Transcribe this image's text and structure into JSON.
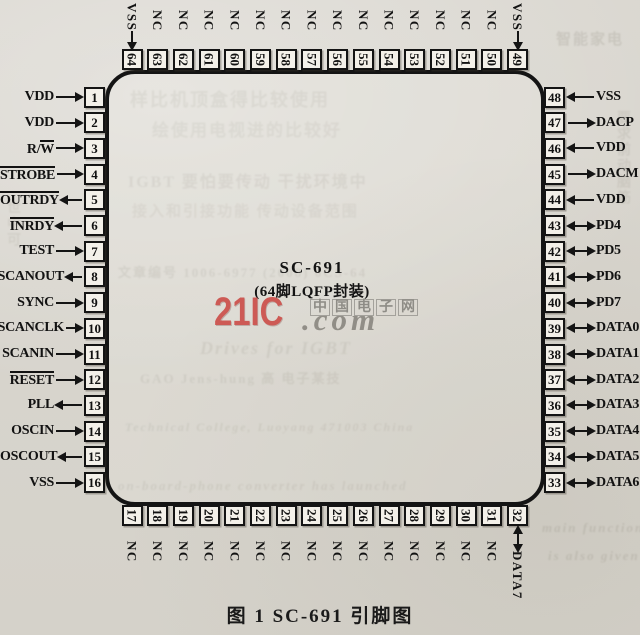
{
  "figure": {
    "chip_name": "SC-691",
    "package": "(64脚LQFP封装)",
    "caption": "图 1  SC-691 引脚图"
  },
  "watermark": {
    "brand": "21IC",
    "cn": "中国电子网",
    "com": ".com",
    "brand_color": "#cd5a55",
    "gray_color": "#8e8c86"
  },
  "colors": {
    "paper": "#d8d5cd",
    "ink": "#141414",
    "pin_box_fill": "#f3f0e9"
  },
  "pins": {
    "left": [
      {
        "num": 1,
        "label": "VDD",
        "dir": "in"
      },
      {
        "num": 2,
        "label": "VDD",
        "dir": "in"
      },
      {
        "num": 3,
        "segments": [
          {
            "t": "R/",
            "ol": false
          },
          {
            "t": "W",
            "ol": true
          }
        ],
        "dir": "in"
      },
      {
        "num": 4,
        "label": "STROBE",
        "ol": true,
        "dir": "in"
      },
      {
        "num": 5,
        "label": "OUTRDY",
        "ol": true,
        "dir": "out"
      },
      {
        "num": 6,
        "label": "INRDY",
        "ol": true,
        "dir": "out"
      },
      {
        "num": 7,
        "label": "TEST",
        "dir": "in"
      },
      {
        "num": 8,
        "label": "SCANOUT",
        "dir": "out"
      },
      {
        "num": 9,
        "label": "SYNC",
        "dir": "in"
      },
      {
        "num": 10,
        "label": "SCANCLK",
        "dir": "in"
      },
      {
        "num": 11,
        "label": "SCANIN",
        "dir": "in"
      },
      {
        "num": 12,
        "label": "RESET",
        "ol": true,
        "dir": "in"
      },
      {
        "num": 13,
        "label": "PLL",
        "dir": "out"
      },
      {
        "num": 14,
        "label": "OSCIN",
        "dir": "in"
      },
      {
        "num": 15,
        "label": "OSCOUT",
        "dir": "out"
      },
      {
        "num": 16,
        "label": "VSS",
        "dir": "in"
      }
    ],
    "right": [
      {
        "num": 48,
        "label": "VSS",
        "dir": "in"
      },
      {
        "num": 47,
        "label": "DACP",
        "dir": "out"
      },
      {
        "num": 46,
        "label": "VDD",
        "dir": "in"
      },
      {
        "num": 45,
        "label": "DACM",
        "dir": "out"
      },
      {
        "num": 44,
        "label": "VDD",
        "dir": "in"
      },
      {
        "num": 43,
        "label": "PD4",
        "dir": "bidir"
      },
      {
        "num": 42,
        "label": "PD5",
        "dir": "bidir"
      },
      {
        "num": 41,
        "label": "PD6",
        "dir": "bidir"
      },
      {
        "num": 40,
        "label": "PD7",
        "dir": "bidir"
      },
      {
        "num": 39,
        "label": "DATA0",
        "dir": "bidir"
      },
      {
        "num": 38,
        "label": "DATA1",
        "dir": "bidir"
      },
      {
        "num": 37,
        "label": "DATA2",
        "dir": "bidir"
      },
      {
        "num": 36,
        "label": "DATA3",
        "dir": "bidir"
      },
      {
        "num": 35,
        "label": "DATA4",
        "dir": "bidir"
      },
      {
        "num": 34,
        "label": "DATA5",
        "dir": "bidir"
      },
      {
        "num": 33,
        "label": "DATA6",
        "dir": "bidir"
      }
    ],
    "top": [
      {
        "num": 64,
        "label": "VSS",
        "dir": "in"
      },
      {
        "num": 63,
        "label": "NC",
        "dir": "none"
      },
      {
        "num": 62,
        "label": "NC",
        "dir": "none"
      },
      {
        "num": 61,
        "label": "NC",
        "dir": "none"
      },
      {
        "num": 60,
        "label": "NC",
        "dir": "none"
      },
      {
        "num": 59,
        "label": "NC",
        "dir": "none"
      },
      {
        "num": 58,
        "label": "NC",
        "dir": "none"
      },
      {
        "num": 57,
        "label": "NC",
        "dir": "none"
      },
      {
        "num": 56,
        "label": "NC",
        "dir": "none"
      },
      {
        "num": 55,
        "label": "NC",
        "dir": "none"
      },
      {
        "num": 54,
        "label": "NC",
        "dir": "none"
      },
      {
        "num": 53,
        "label": "NC",
        "dir": "none"
      },
      {
        "num": 52,
        "label": "NC",
        "dir": "none"
      },
      {
        "num": 51,
        "label": "NC",
        "dir": "none"
      },
      {
        "num": 50,
        "label": "NC",
        "dir": "none"
      },
      {
        "num": 49,
        "label": "VSS",
        "dir": "in"
      }
    ],
    "bottom": [
      {
        "num": 17,
        "label": "NC",
        "dir": "none"
      },
      {
        "num": 18,
        "label": "NC",
        "dir": "none"
      },
      {
        "num": 19,
        "label": "NC",
        "dir": "none"
      },
      {
        "num": 20,
        "label": "NC",
        "dir": "none"
      },
      {
        "num": 21,
        "label": "NC",
        "dir": "none"
      },
      {
        "num": 22,
        "label": "NC",
        "dir": "none"
      },
      {
        "num": 23,
        "label": "NC",
        "dir": "none"
      },
      {
        "num": 24,
        "label": "NC",
        "dir": "none"
      },
      {
        "num": 25,
        "label": "NC",
        "dir": "none"
      },
      {
        "num": 26,
        "label": "NC",
        "dir": "none"
      },
      {
        "num": 27,
        "label": "NC",
        "dir": "none"
      },
      {
        "num": 28,
        "label": "NC",
        "dir": "none"
      },
      {
        "num": 29,
        "label": "NC",
        "dir": "none"
      },
      {
        "num": 30,
        "label": "NC",
        "dir": "none"
      },
      {
        "num": 31,
        "label": "NC",
        "dir": "none"
      },
      {
        "num": 32,
        "label": "DATA7",
        "dir": "bidir"
      }
    ]
  },
  "bleedthrough": [
    {
      "t": "样比机顶盒得比较使用",
      "x": 130,
      "y": 86,
      "s": 18,
      "o": 0.11
    },
    {
      "t": "绘使用电视进的比较好",
      "x": 152,
      "y": 116,
      "s": 17,
      "o": 0.1
    },
    {
      "t": "IGBT 要怕要传动 干扰环境中",
      "x": 128,
      "y": 168,
      "s": 16,
      "o": 0.12
    },
    {
      "t": "接入和引接功能 传动设备范围",
      "x": 132,
      "y": 200,
      "s": 15,
      "o": 0.1
    },
    {
      "t": "文章编号 1006-6977 (2008) 0CS-64",
      "x": 118,
      "y": 262,
      "s": 13,
      "o": 0.14
    },
    {
      "t": "Drives for IGBT",
      "x": 200,
      "y": 338,
      "s": 18,
      "i": true,
      "o": 0.14
    },
    {
      "t": "GAO Jens-hung 高 电子某技",
      "x": 140,
      "y": 368,
      "s": 13,
      "o": 0.14
    },
    {
      "t": "Technical College, Luoyang 471003 China",
      "x": 125,
      "y": 420,
      "s": 12,
      "i": true,
      "o": 0.14
    },
    {
      "t": "on-board-phone converter has launched",
      "x": 118,
      "y": 478,
      "s": 13,
      "i": true,
      "o": 0.14
    },
    {
      "t": "main functions",
      "x": 542,
      "y": 520,
      "s": 13,
      "i": true,
      "o": 0.16
    },
    {
      "t": "is also given",
      "x": 548,
      "y": 548,
      "s": 13,
      "i": true,
      "o": 0.16
    },
    {
      "t": "智能家电",
      "x": 556,
      "y": 28,
      "s": 15,
      "o": 0.16
    },
    {
      "t": "要求前动脑筋",
      "x": 612,
      "y": 110,
      "s": 14,
      "v": true,
      "o": 0.12
    },
    {
      "t": "世中可",
      "x": 2,
      "y": 200,
      "s": 14,
      "v": true,
      "o": 0.1
    }
  ]
}
